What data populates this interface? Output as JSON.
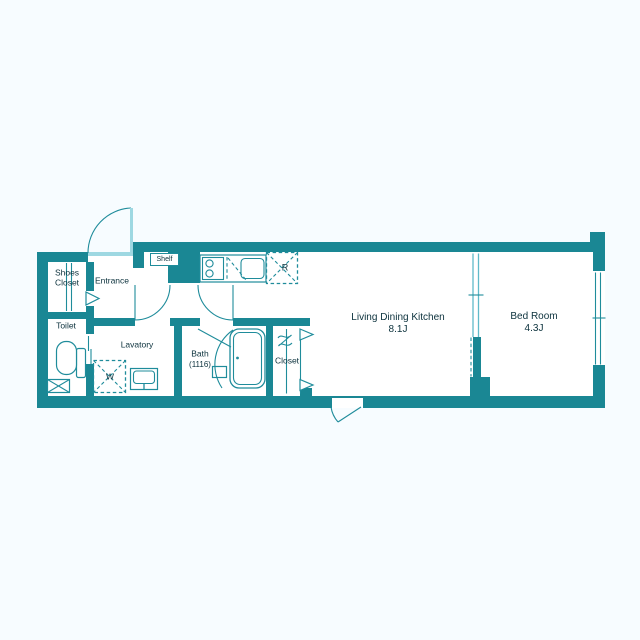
{
  "colors": {
    "wall": "#1a8794",
    "line": "#1f8c9b",
    "light": "#9ed8e2",
    "mid": "#5fbac9",
    "room": "#ffffff",
    "background": "#f7fcff",
    "text": "#0b313c"
  },
  "rooms": {
    "shoes_closet": {
      "lines": [
        "Shoes",
        "Closet"
      ]
    },
    "entrance": {
      "label": "Entrance"
    },
    "toilet": {
      "label": "Toilet"
    },
    "lavatory": {
      "label": "Lavatory"
    },
    "bath": {
      "label": "Bath",
      "dimension": "(1116)"
    },
    "closet": {
      "label": "Closet"
    },
    "living_dining_kitchen": {
      "label": "Living Dining Kitchen",
      "area": "8.1J"
    },
    "bed_room": {
      "label": "Bed Room",
      "area": "4.3J"
    }
  },
  "fixtures": {
    "shelf_label": "Shelf",
    "refrigerator_mark": "R",
    "washing_machine_mark": "W"
  }
}
